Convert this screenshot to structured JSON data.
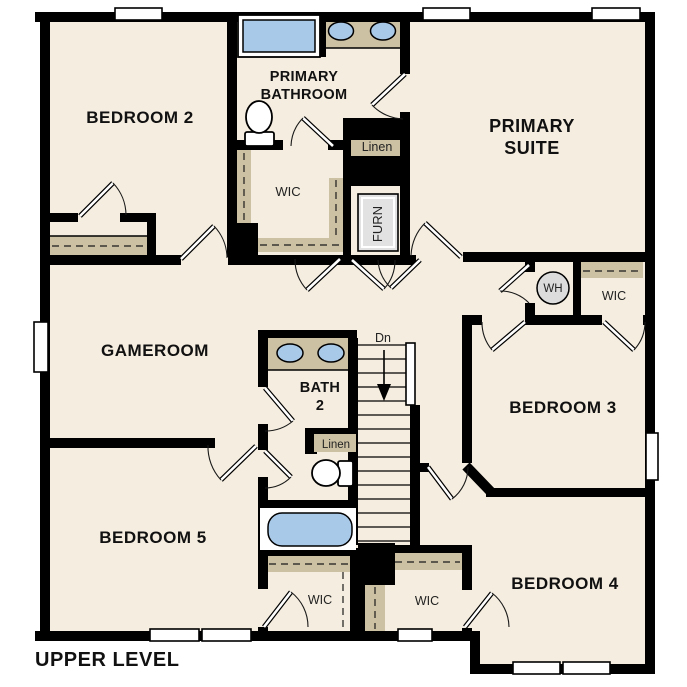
{
  "title": "UPPER LEVEL",
  "rooms": {
    "bedroom2": {
      "label": "BEDROOM 2"
    },
    "primary_bathroom": {
      "line1": "PRIMARY",
      "line2": "BATHROOM"
    },
    "primary_suite": {
      "line1": "PRIMARY",
      "line2": "SUITE"
    },
    "gameroom": {
      "label": "GAMEROOM"
    },
    "bath2": {
      "line1": "BATH",
      "line2": "2"
    },
    "bedroom3": {
      "label": "BEDROOM 3"
    },
    "bedroom4": {
      "label": "BEDROOM 4"
    },
    "bedroom5": {
      "label": "BEDROOM 5"
    }
  },
  "closets": {
    "primary_wic": "WIC",
    "bedroom3_wic": "WIC",
    "bedroom5_wic": "WIC",
    "bedroom4_wic": "WIC",
    "linen_upper": "Linen",
    "linen_bath2": "Linen",
    "furnace": "FURN"
  },
  "fixtures": {
    "water_heater": "WH"
  },
  "stairs": {
    "direction_label": "Dn"
  },
  "colors": {
    "wall": "#000000",
    "floor": "#f5eddf",
    "counter_tan": "#cdc1a4",
    "fixture_blue": "#a9c9e9",
    "water_heater_gray": "#dcdcdc"
  }
}
